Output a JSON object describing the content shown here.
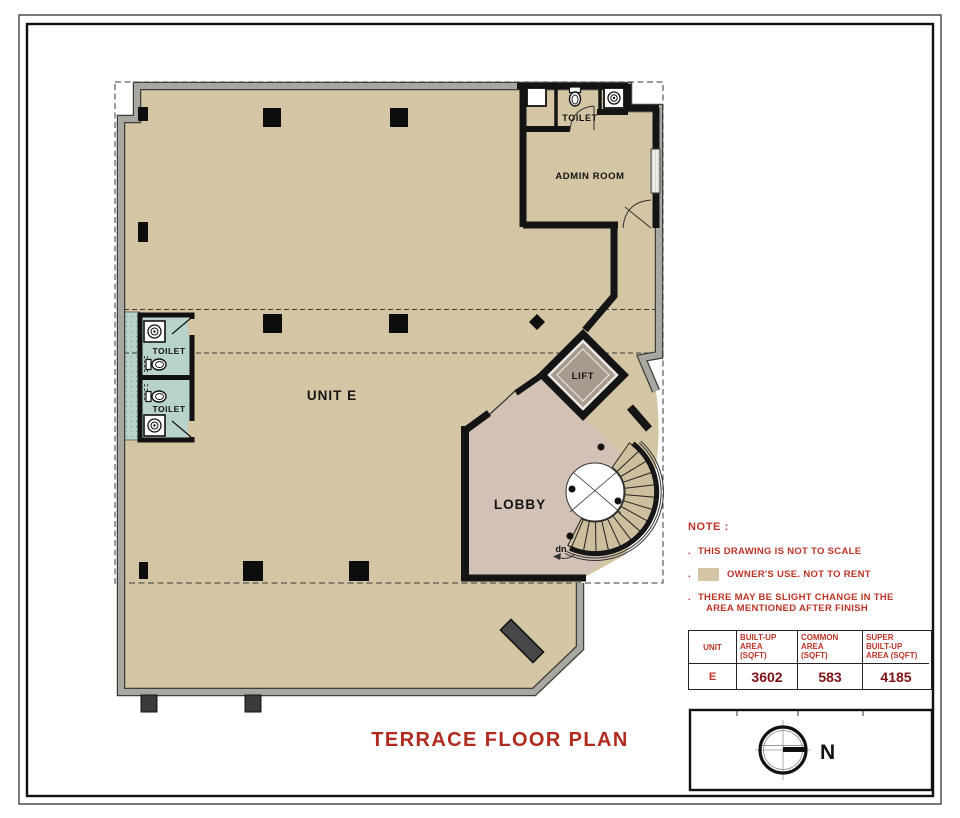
{
  "page": {
    "title": "TERRACE FLOOR PLAN"
  },
  "plan": {
    "labels": {
      "unit": "UNIT E",
      "lobby": "LOBBY",
      "lift": "LIFT",
      "admin_room": "ADMIN ROOM",
      "toilet_top": "TOILET",
      "toilet_upper": "TOILET",
      "toilet_lower": "TOILET",
      "stair_down": "dn"
    },
    "colors": {
      "floor_tan": "#D4C5A4",
      "toilet_teal": "#B7D3CA",
      "lobby_pink": "#D3C1B6",
      "lift_gray": "#A89B8E",
      "stair_tread": "#CDBE9E"
    }
  },
  "note": {
    "heading": "NOTE :",
    "bullet": ".",
    "item1": "THIS DRAWING IS NOT TO SCALE",
    "item2": "OWNER'S USE. NOT TO RENT",
    "item3_line1": "THERE MAY BE SLIGHT CHANGE IN THE",
    "item3_line2": "AREA MENTIONED AFTER FINISH",
    "legend_swatch_color": "#D4C5A4"
  },
  "area_table": {
    "headers": [
      "UNIT",
      "BUILT-UP\nAREA\n(SQFT)",
      "COMMON\nAREA\n(SQFT)",
      "SUPER\nBUILT-UP\nAREA (SQFT)"
    ],
    "row": {
      "unit": "E",
      "built_up": "3602",
      "common": "583",
      "super_built_up": "4185"
    }
  },
  "compass": {
    "north_label": "N"
  }
}
